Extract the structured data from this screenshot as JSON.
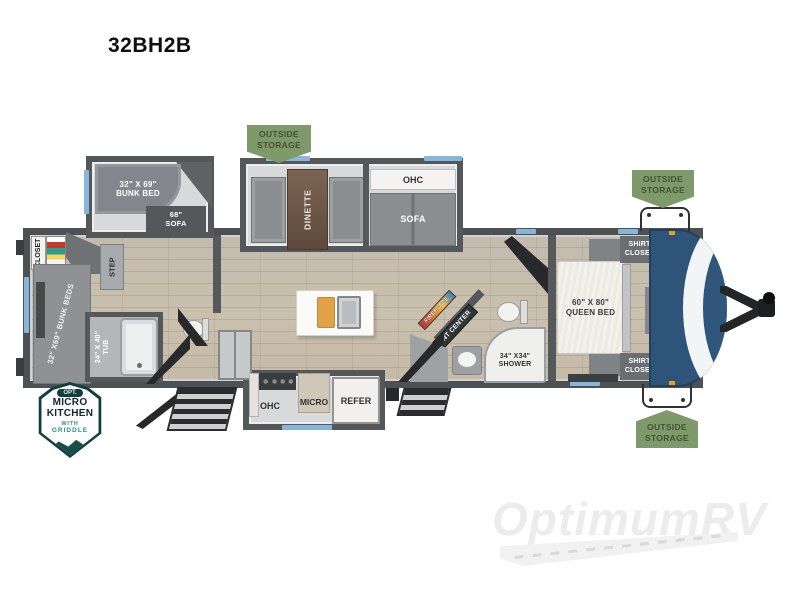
{
  "title": "32BH2B",
  "storage_badge": {
    "line1": "OUTSIDE",
    "line2": "STORAGE"
  },
  "rear_slide": {
    "bunk_size": "32\" X 69\"",
    "bunk_name": "BUNK BED",
    "sofa_size": "68\"",
    "sofa_name": "SOFA"
  },
  "main_slide": {
    "dinette": "DINETTE",
    "ohc": "OHC",
    "sofa": "SOFA"
  },
  "rear_room": {
    "closet": "CLOSET",
    "step": "STEP",
    "bunks": "32\" X69\" BUNK BEDS",
    "tub_size": "24\" X 40\"",
    "tub_name": "TUB"
  },
  "kitchen": {
    "ohc": "OHC",
    "micro": "MICRO",
    "refer": "REFER"
  },
  "living": {
    "fireplace": "FIREPLACE",
    "ent_center": "ENT CENTER"
  },
  "bathroom": {
    "shower_size": "34\" X34\"",
    "shower_name": "SHOWER"
  },
  "bedroom": {
    "bed_size": "60\" X 80\"",
    "bed_name": "QUEEN BED",
    "shirt_line1": "SHIRT",
    "shirt_line2": "CLOSET",
    "ohc": "OHC"
  },
  "front_cap": {
    "brand": "FOREST RIVER",
    "model": "PUMA"
  },
  "option_badge": {
    "tag": "OPT.",
    "line1": "MICRO",
    "line2": "KITCHEN",
    "line3": "WITH",
    "line4": "GRIDDLE"
  },
  "watermark": "OptimumRV",
  "colors": {
    "storage_badge_bg": "#7e9a6b",
    "storage_badge_text": "#44522e",
    "cap_blue": "#2f547a",
    "window_blue": "#86b7da",
    "floor_tan": "#c7bcaa",
    "wall_gray": "#55585b",
    "option_badge_teal": "#113f3c",
    "option_badge_accent": "#2c9183",
    "watermark_gray": "#ececec"
  }
}
